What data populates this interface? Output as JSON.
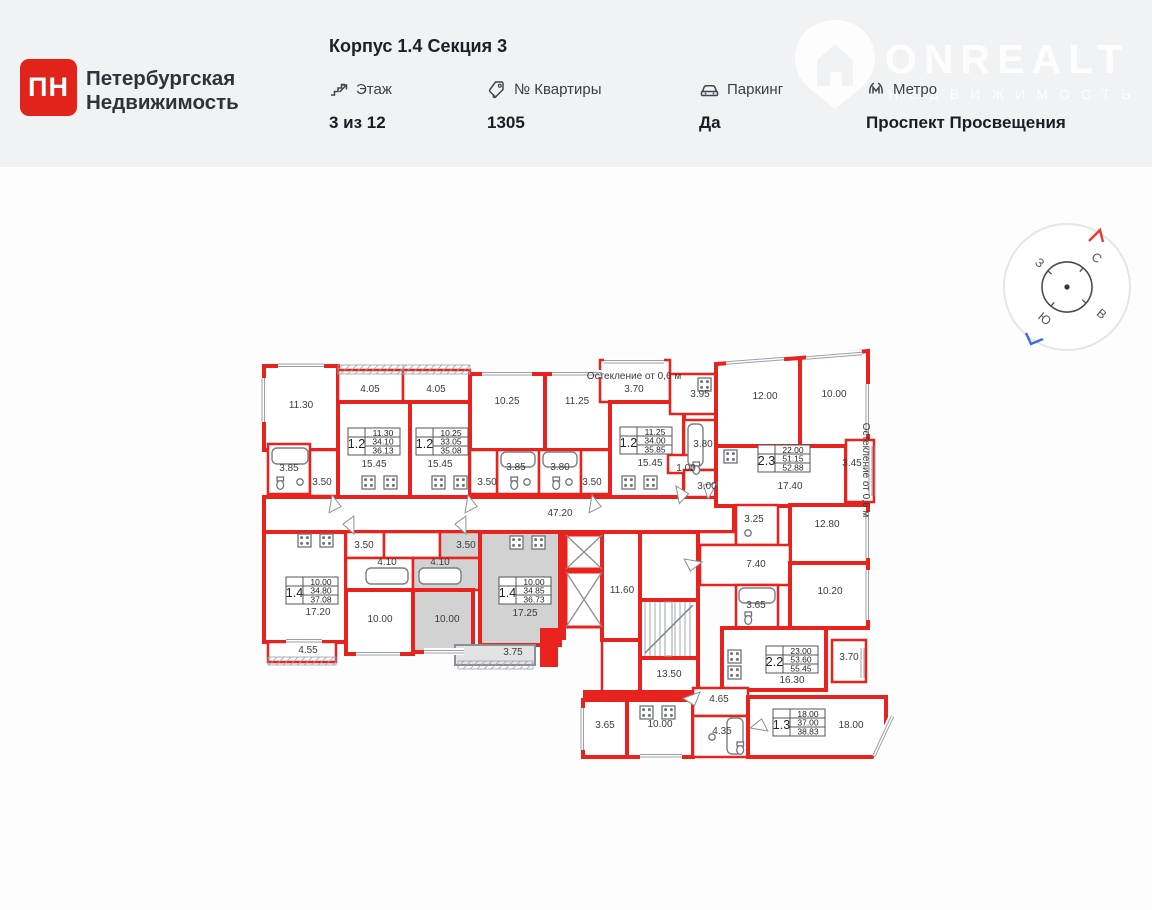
{
  "header": {
    "logo": {
      "abbr": "ПН",
      "name_line1": "Петербургская",
      "name_line2": "Недвижимость"
    },
    "title": "Корпус 1.4 Секция 3",
    "info": [
      {
        "id": "floor",
        "label": "Этаж",
        "value": "3 из 12"
      },
      {
        "id": "apt-no",
        "label": "№ Квартиры",
        "value": "1305"
      },
      {
        "id": "parking",
        "label": "Паркинг",
        "value": "Да"
      },
      {
        "id": "metro",
        "label": "Метро",
        "value": "Проспект Просвещения"
      }
    ],
    "watermark": {
      "brand": "ONREALT",
      "subtitle": "НЕДВИЖИМОСТЬ"
    }
  },
  "compass": {
    "letters": [
      {
        "t": "С",
        "x": 1094,
        "y": 261,
        "r": 40
      },
      {
        "t": "В",
        "x": 1099,
        "y": 317,
        "r": 40
      },
      {
        "t": "Ю",
        "x": 1042,
        "y": 322,
        "r": 40
      },
      {
        "t": "З",
        "x": 1037,
        "y": 266,
        "r": 40
      }
    ]
  },
  "plan": {
    "wall_color": "#e8231d",
    "selected_fill": "#d2d2d2",
    "glazing_note": "Остекление от 0,6 м",
    "apartment_tables": [
      {
        "type": "1.2",
        "x": 348,
        "y": 428,
        "values": [
          "11.30",
          "34.10",
          "36.13"
        ]
      },
      {
        "type": "1.2",
        "x": 416,
        "y": 428,
        "values": [
          "10.25",
          "33.05",
          "35.08"
        ]
      },
      {
        "type": "1.2",
        "x": 620,
        "y": 427,
        "values": [
          "11.25",
          "34.00",
          "35.85"
        ]
      },
      {
        "type": "2.3",
        "x": 758,
        "y": 445,
        "values": [
          "22.00",
          "51.15",
          "52.88"
        ]
      },
      {
        "type": "1.4",
        "x": 286,
        "y": 577,
        "values": [
          "10.00",
          "34.80",
          "37.08"
        ]
      },
      {
        "type": "1.4",
        "x": 499,
        "y": 577,
        "values": [
          "10.00",
          "34.85",
          "36.73"
        ],
        "selected": true
      },
      {
        "type": "2.2",
        "x": 766,
        "y": 646,
        "values": [
          "23.00",
          "53.60",
          "55.45"
        ]
      },
      {
        "type": "1.3",
        "x": 773,
        "y": 709,
        "values": [
          "18.00",
          "37.00",
          "38.83"
        ]
      }
    ],
    "labels": [
      {
        "t": "11.30",
        "x": 301,
        "y": 408
      },
      {
        "t": "4.05",
        "x": 370,
        "y": 392
      },
      {
        "t": "4.05",
        "x": 436,
        "y": 392
      },
      {
        "t": "10.25",
        "x": 507,
        "y": 404
      },
      {
        "t": "11.25",
        "x": 577,
        "y": 404
      },
      {
        "t": "Остекление от 0,6 м",
        "x": 634,
        "y": 379,
        "s": 6.5
      },
      {
        "t": "3.70",
        "x": 634,
        "y": 392
      },
      {
        "t": "3.95",
        "x": 700,
        "y": 397
      },
      {
        "t": "12.00",
        "x": 765,
        "y": 399
      },
      {
        "t": "10.00",
        "x": 834,
        "y": 397
      },
      {
        "t": "15.45",
        "x": 374,
        "y": 467
      },
      {
        "t": "15.45",
        "x": 440,
        "y": 467
      },
      {
        "t": "15.45",
        "x": 650,
        "y": 466
      },
      {
        "t": "3.85",
        "x": 289,
        "y": 471
      },
      {
        "t": "3.50",
        "x": 322,
        "y": 485
      },
      {
        "t": "3.85",
        "x": 516,
        "y": 470
      },
      {
        "t": "3.80",
        "x": 560,
        "y": 470
      },
      {
        "t": "3.50",
        "x": 487,
        "y": 485
      },
      {
        "t": "3.50",
        "x": 592,
        "y": 485
      },
      {
        "t": "1.00",
        "x": 686,
        "y": 471
      },
      {
        "t": "3.00",
        "x": 707,
        "y": 489
      },
      {
        "t": "3.80",
        "x": 703,
        "y": 447
      },
      {
        "t": "17.40",
        "x": 790,
        "y": 489
      },
      {
        "t": "3.45",
        "x": 852,
        "y": 466
      },
      {
        "t": "Остекление от 0,6 м",
        "x": 863,
        "y": 470,
        "s": 6.5,
        "r": 90
      },
      {
        "t": "47.20",
        "x": 560,
        "y": 516
      },
      {
        "t": "3.50",
        "x": 364,
        "y": 548
      },
      {
        "t": "4.10",
        "x": 387,
        "y": 565
      },
      {
        "t": "10.00",
        "x": 380,
        "y": 622
      },
      {
        "t": "3.50",
        "x": 466,
        "y": 548
      },
      {
        "t": "4.10",
        "x": 440,
        "y": 565
      },
      {
        "t": "10.00",
        "x": 447,
        "y": 622
      },
      {
        "t": "17.20",
        "x": 318,
        "y": 615
      },
      {
        "t": "4.55",
        "x": 308,
        "y": 653
      },
      {
        "t": "17.25",
        "x": 525,
        "y": 616
      },
      {
        "t": "3.75",
        "x": 513,
        "y": 655
      },
      {
        "t": "11.60",
        "x": 622,
        "y": 593
      },
      {
        "t": "13.50",
        "x": 669,
        "y": 677
      },
      {
        "t": "3.25",
        "x": 754,
        "y": 522
      },
      {
        "t": "12.80",
        "x": 827,
        "y": 527
      },
      {
        "t": "7.40",
        "x": 756,
        "y": 567
      },
      {
        "t": "10.20",
        "x": 830,
        "y": 594
      },
      {
        "t": "3.65",
        "x": 756,
        "y": 608
      },
      {
        "t": "16.30",
        "x": 792,
        "y": 683
      },
      {
        "t": "3.70",
        "x": 849,
        "y": 660
      },
      {
        "t": "3.65",
        "x": 605,
        "y": 728
      },
      {
        "t": "10.00",
        "x": 660,
        "y": 727
      },
      {
        "t": "4.65",
        "x": 719,
        "y": 702
      },
      {
        "t": "4.35",
        "x": 722,
        "y": 734
      },
      {
        "t": "18.00",
        "x": 851,
        "y": 728
      }
    ]
  }
}
